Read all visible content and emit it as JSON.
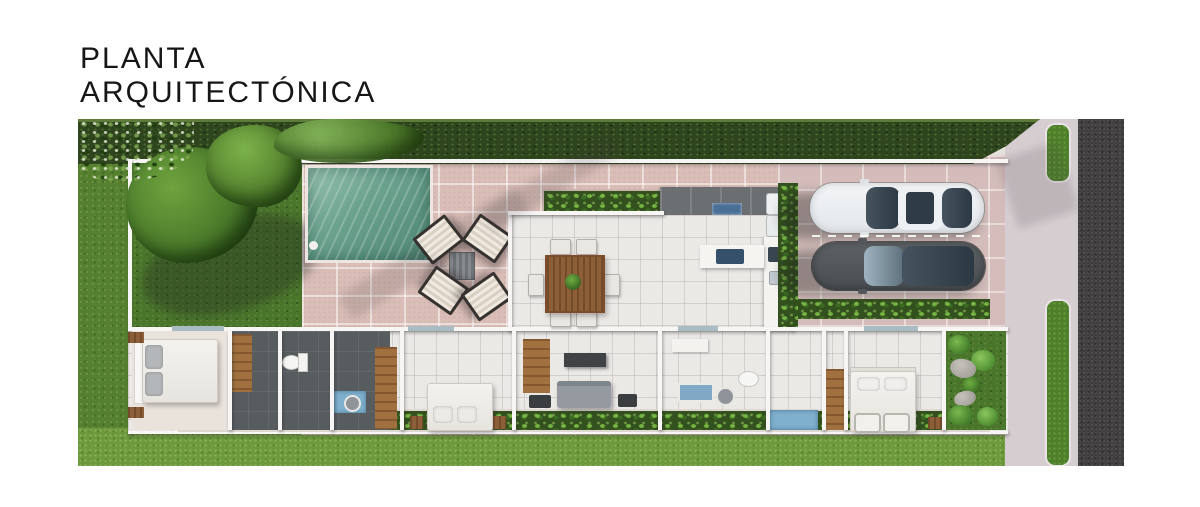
{
  "title": {
    "line1": "PLANTA",
    "line2": "ARQUITECTÓNICA"
  },
  "palette": {
    "title-text": "#161616",
    "grass": "#55802f",
    "lawn": "#6e9a3e",
    "garden": "#4a762b",
    "hedge": "#2e451d",
    "paver": "#d9bdb6",
    "tile": "#ebe9e6",
    "charcoal": "#575c5f",
    "wood": "#a0703f",
    "pool-a": "#6ca38f",
    "pool-b": "#4f8674",
    "planter": "#33511e",
    "street": "#413f40",
    "sidewalk": "#d6cdd1",
    "verge": "#4e7f2b",
    "wall": "#f7f6f5",
    "car-white": "#e2e6ea",
    "car-dark": "#474c50",
    "glass": "#2c3843",
    "window": "#a9bcc3",
    "water": "#7fb0cc"
  },
  "scene": {
    "type": "aerial-3d-floor-plan-render",
    "areas": [
      "garden with trees",
      "swimming pool",
      "outdoor lounge",
      "planter bed",
      "dining area",
      "kitchen",
      "living area",
      "bedrooms",
      "bathrooms",
      "walk-in closets",
      "rock garden",
      "carport with two cars",
      "driveway",
      "sidewalk with green verges",
      "street"
    ]
  }
}
